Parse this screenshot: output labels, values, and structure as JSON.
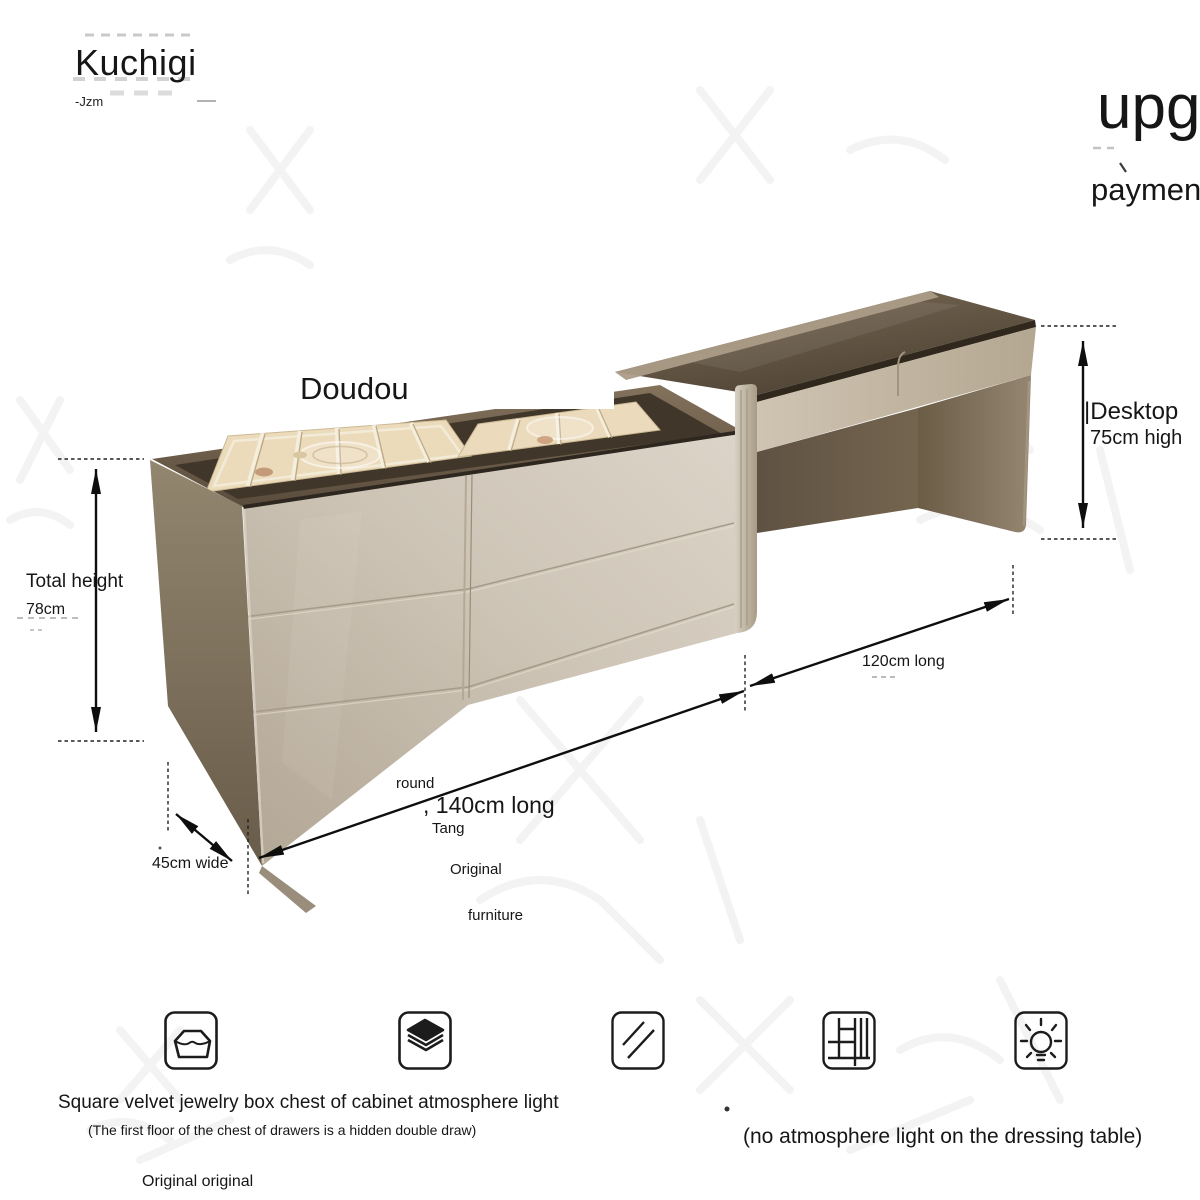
{
  "header": {
    "brand": "Kuchigi",
    "brand_sub": "-Jzm",
    "promo_top": "upg",
    "promo_bottom": "paymen"
  },
  "product": {
    "label": "Doudou"
  },
  "dims": {
    "total_height_label": "Total height",
    "total_height_value": "78cm",
    "desktop_label": "|Desktop",
    "desktop_value": "75cm high",
    "desk_length": "120cm long",
    "chest_length": ", 140cm long",
    "chest_length_prefix": "round",
    "word_tang": "Tang",
    "word_original": "Original",
    "word_furniture": "furniture",
    "width": "45cm wide"
  },
  "features": {
    "caption": "Square velvet jewelry box chest of cabinet atmosphere light",
    "subcaption": "(The first floor of the chest of drawers is a hidden double draw)",
    "note_left": "Original original",
    "note_right": "(no atmosphere light on the dressing table)",
    "icons": [
      "jewelry-box-icon",
      "velvet-layers-icon",
      "mirror-glass-icon",
      "compartment-grid-icon",
      "atmosphere-light-icon"
    ]
  },
  "colors": {
    "text": "#161616",
    "dimension_line": "#0e0e0e",
    "cabinet_front": "#d2c9bb",
    "cabinet_side": "#7e7161",
    "wood_top": "#5f5140",
    "tray_velvet": "#e8dcc1",
    "desk_glass": "#5c4f3e",
    "background": "#ffffff"
  }
}
